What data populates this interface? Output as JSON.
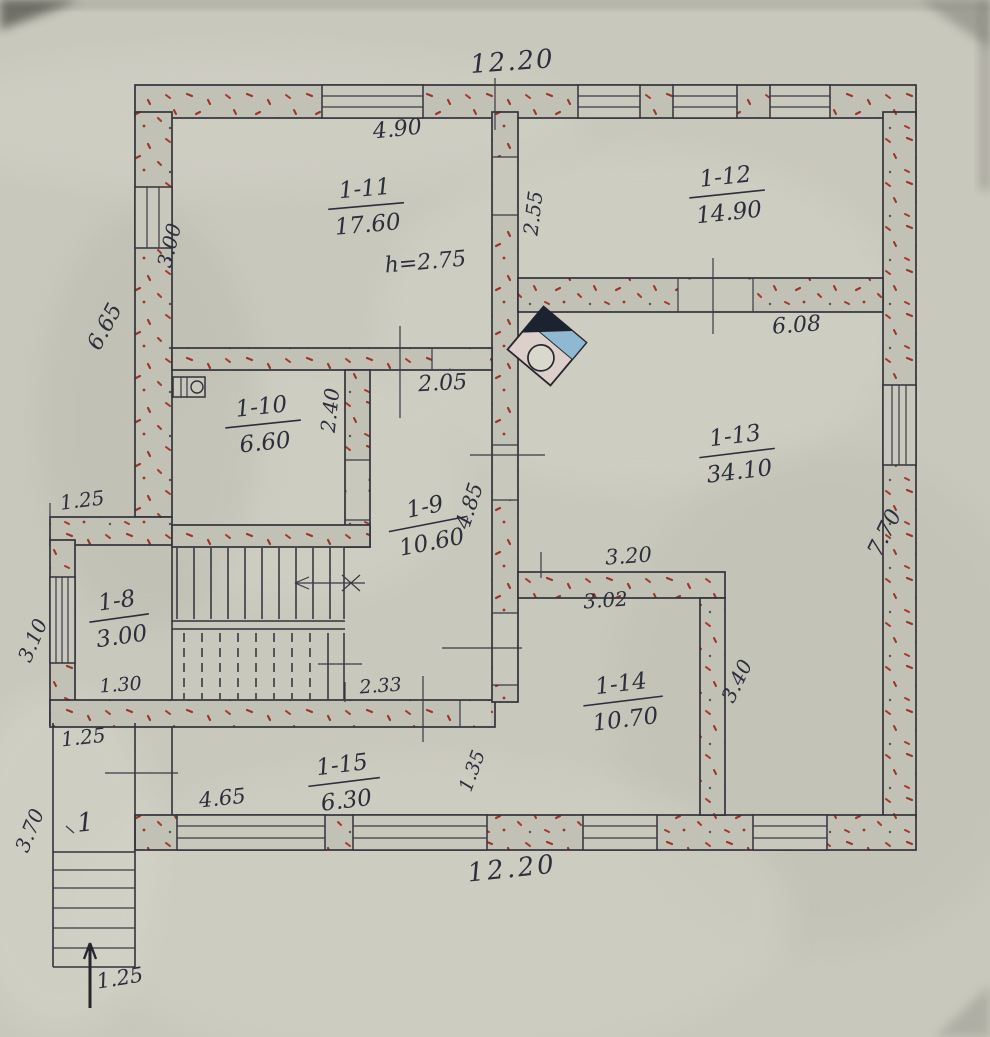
{
  "rooms": {
    "r8": {
      "number": "1-8",
      "area": "3.00"
    },
    "r9": {
      "number": "1-9",
      "area": "10.60"
    },
    "r10": {
      "number": "1-10",
      "area": "6.60"
    },
    "r11": {
      "number": "1-11",
      "area": "17.60"
    },
    "r12": {
      "number": "1-12",
      "area": "14.90"
    },
    "r13": {
      "number": "1-13",
      "area": "34.10"
    },
    "r14": {
      "number": "1-14",
      "area": "10.70"
    },
    "r15": {
      "number": "1-15",
      "area": "6.30"
    },
    "porch": {
      "number": "1"
    }
  },
  "annotations": {
    "ceiling_height": "h=2.75"
  },
  "dims": {
    "top_width": "12.20",
    "bottom_width": "12.20",
    "window_1_11": "4.90",
    "room_1_12_depth": "2.55",
    "room_1_12_width": "6.08",
    "left_wall_window": "3.00",
    "left_wall_height": "6.65",
    "door_1_11": "2.05",
    "room_1_10_depth": "2.40",
    "hall_1_9_length": "4.85",
    "right_wall_height": "7.70",
    "stair_block_offset": "1.25",
    "stair_block_width": "3.10",
    "room_1_8_width": "1.30",
    "stair_width": "2.33",
    "room_1_14_width_outer": "3.20",
    "room_1_14_width_inner": "3.02",
    "room_1_14_depth": "3.40",
    "door_1_15": "1.35",
    "room_1_15_width": "4.65",
    "porch_width": "1.25",
    "porch_depth": "3.70",
    "steps_width": "1.25"
  }
}
